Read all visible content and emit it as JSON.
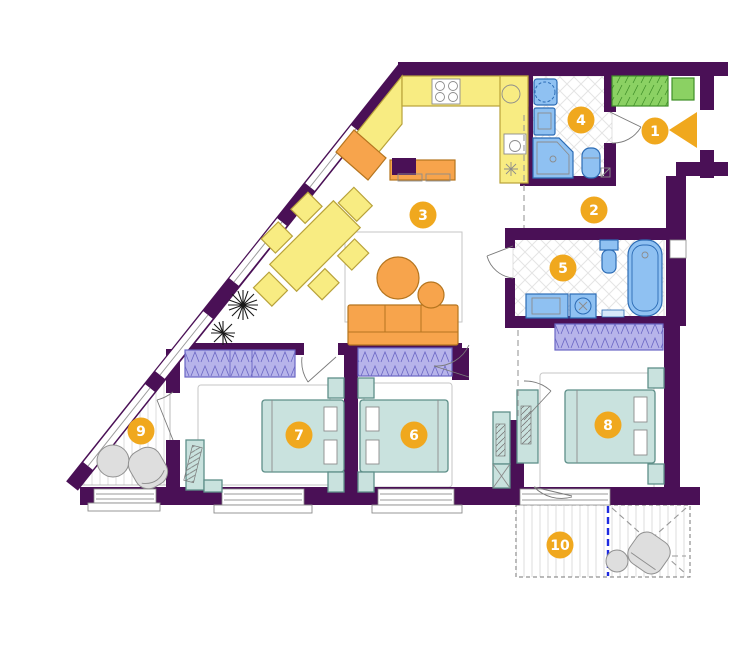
{
  "plan_title": "apartment-floor-plan",
  "colors": {
    "wall": "#4A1056",
    "badge": "#F0A81E",
    "badge_text": "#FFFFFF",
    "kitchen_yellow": "#F8EC82",
    "yellow_border": "#B8A23A",
    "orange": "#F7A44C",
    "orange_border": "#B5751F",
    "teal": "#C9E2DE",
    "teal_border": "#5E8F89",
    "lavender": "#B7B4EA",
    "lavender_border": "#6A66C4",
    "green": "#8BD163",
    "green_border": "#3F8F28",
    "blue": "#8FC1F2",
    "blue_border": "#2C6CB5",
    "gray_furniture": "#DEDEDE",
    "section_blue": "#1F2BE0"
  },
  "icons": {
    "entrance_arrow": "left-pointing triangle",
    "plant": "starburst plant symbol"
  },
  "rooms": [
    {
      "number": "1",
      "name": "entry-hall"
    },
    {
      "number": "2",
      "name": "hallway"
    },
    {
      "number": "3",
      "name": "kitchen-living-room"
    },
    {
      "number": "4",
      "name": "bathroom-shower"
    },
    {
      "number": "5",
      "name": "bathroom-tub"
    },
    {
      "number": "6",
      "name": "bedroom-center"
    },
    {
      "number": "7",
      "name": "bedroom-left"
    },
    {
      "number": "8",
      "name": "bedroom-right"
    },
    {
      "number": "9",
      "name": "balcony-triangular"
    },
    {
      "number": "10",
      "name": "balcony-bottom"
    }
  ]
}
